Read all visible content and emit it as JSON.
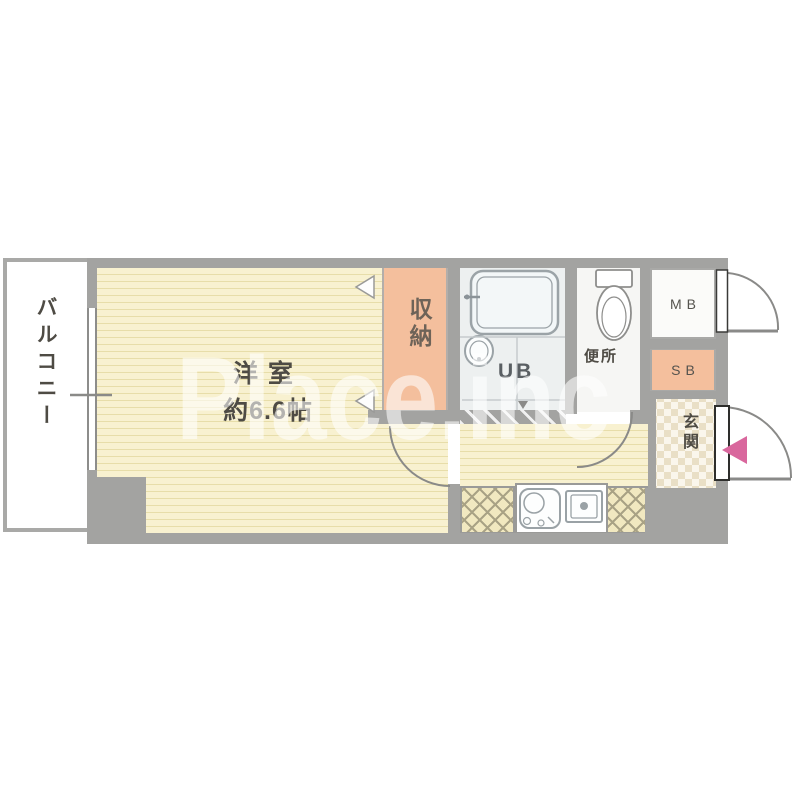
{
  "plan": {
    "watermark": "Place.inc",
    "labels": {
      "balcony": "バルコニー",
      "room_name": "洋室",
      "room_size": "約6.6帖",
      "closet": "収納",
      "unit_bath": "UB",
      "toilet": "便所",
      "meter_box": "MB",
      "shoe_box": "SB",
      "entrance": "玄関"
    },
    "colors": {
      "wall": "#a3a3a1",
      "floor": "#f8f1d0",
      "floor_stripe": "#e7dda9",
      "closet_fill": "#f4bf9d",
      "ub_floor": "#edf0f0",
      "entrance_marker": "#d9679d",
      "watermark_text": "#ffffff"
    }
  }
}
